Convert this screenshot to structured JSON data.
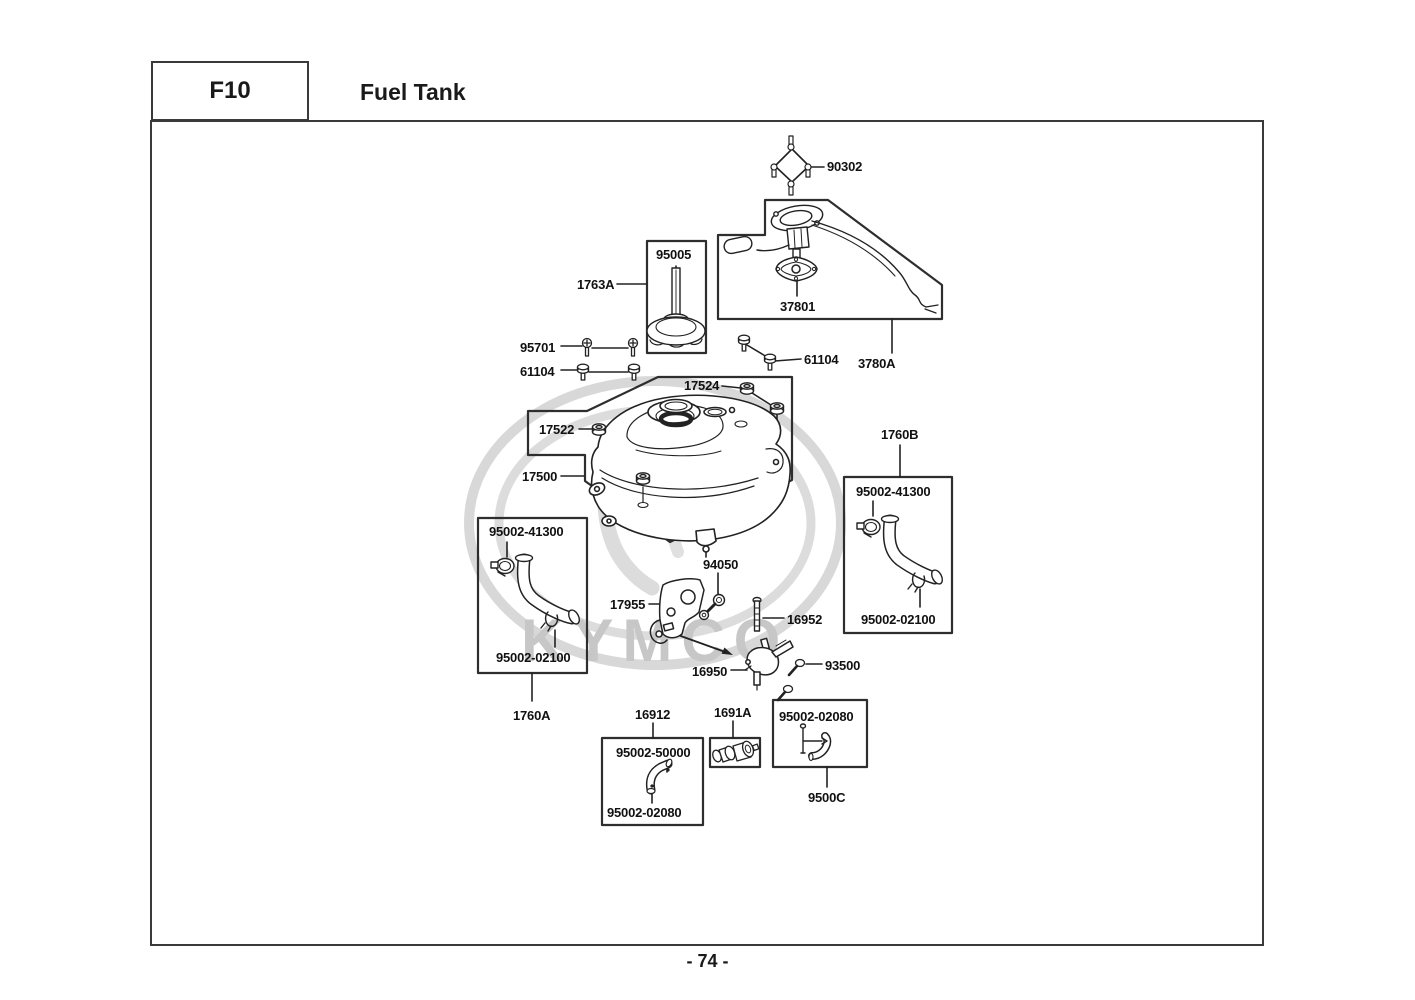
{
  "header": {
    "code": "F10",
    "title": "Fuel Tank"
  },
  "footer": {
    "page": "- 74 -"
  },
  "watermark": {
    "text": "KYMCO"
  },
  "labels": [
    {
      "id": "90302",
      "text": "90302",
      "x": 827,
      "y": 159
    },
    {
      "id": "95005",
      "text": "95005",
      "x": 656,
      "y": 247
    },
    {
      "id": "1763A",
      "text": "1763A",
      "x": 577,
      "y": 277
    },
    {
      "id": "37801",
      "text": "37801",
      "x": 780,
      "y": 299
    },
    {
      "id": "61104-right",
      "text": "61104",
      "x": 804,
      "y": 352
    },
    {
      "id": "3780A",
      "text": "3780A",
      "x": 858,
      "y": 356
    },
    {
      "id": "95701",
      "text": "95701",
      "x": 520,
      "y": 340
    },
    {
      "id": "61104-left",
      "text": "61104",
      "x": 520,
      "y": 364
    },
    {
      "id": "17524",
      "text": "17524",
      "x": 684,
      "y": 378
    },
    {
      "id": "17522",
      "text": "17522",
      "x": 539,
      "y": 422
    },
    {
      "id": "17500",
      "text": "17500",
      "x": 522,
      "y": 469
    },
    {
      "id": "1760B",
      "text": "1760B",
      "x": 881,
      "y": 427
    },
    {
      "id": "95002-41300-r",
      "text": "95002-41300",
      "x": 856,
      "y": 484
    },
    {
      "id": "95002-02100-r",
      "text": "95002-02100",
      "x": 861,
      "y": 612
    },
    {
      "id": "95002-41300-l",
      "text": "95002-41300",
      "x": 489,
      "y": 524
    },
    {
      "id": "95002-02100-l",
      "text": "95002-02100",
      "x": 496,
      "y": 650
    },
    {
      "id": "1760A",
      "text": "1760A",
      "x": 513,
      "y": 708
    },
    {
      "id": "94050",
      "text": "94050",
      "x": 703,
      "y": 557
    },
    {
      "id": "17955",
      "text": "17955",
      "x": 610,
      "y": 597
    },
    {
      "id": "16952",
      "text": "16952",
      "x": 787,
      "y": 612
    },
    {
      "id": "16950",
      "text": "16950",
      "x": 692,
      "y": 664
    },
    {
      "id": "93500",
      "text": "93500",
      "x": 825,
      "y": 658
    },
    {
      "id": "16912",
      "text": "16912",
      "x": 635,
      "y": 707
    },
    {
      "id": "1691A",
      "text": "1691A",
      "x": 714,
      "y": 705
    },
    {
      "id": "95002-50000",
      "text": "95002-50000",
      "x": 616,
      "y": 745
    },
    {
      "id": "95002-02080-l",
      "text": "95002-02080",
      "x": 607,
      "y": 805
    },
    {
      "id": "95002-02080-r",
      "text": "95002-02080",
      "x": 779,
      "y": 709
    },
    {
      "id": "9500C",
      "text": "9500C",
      "x": 808,
      "y": 790
    }
  ]
}
